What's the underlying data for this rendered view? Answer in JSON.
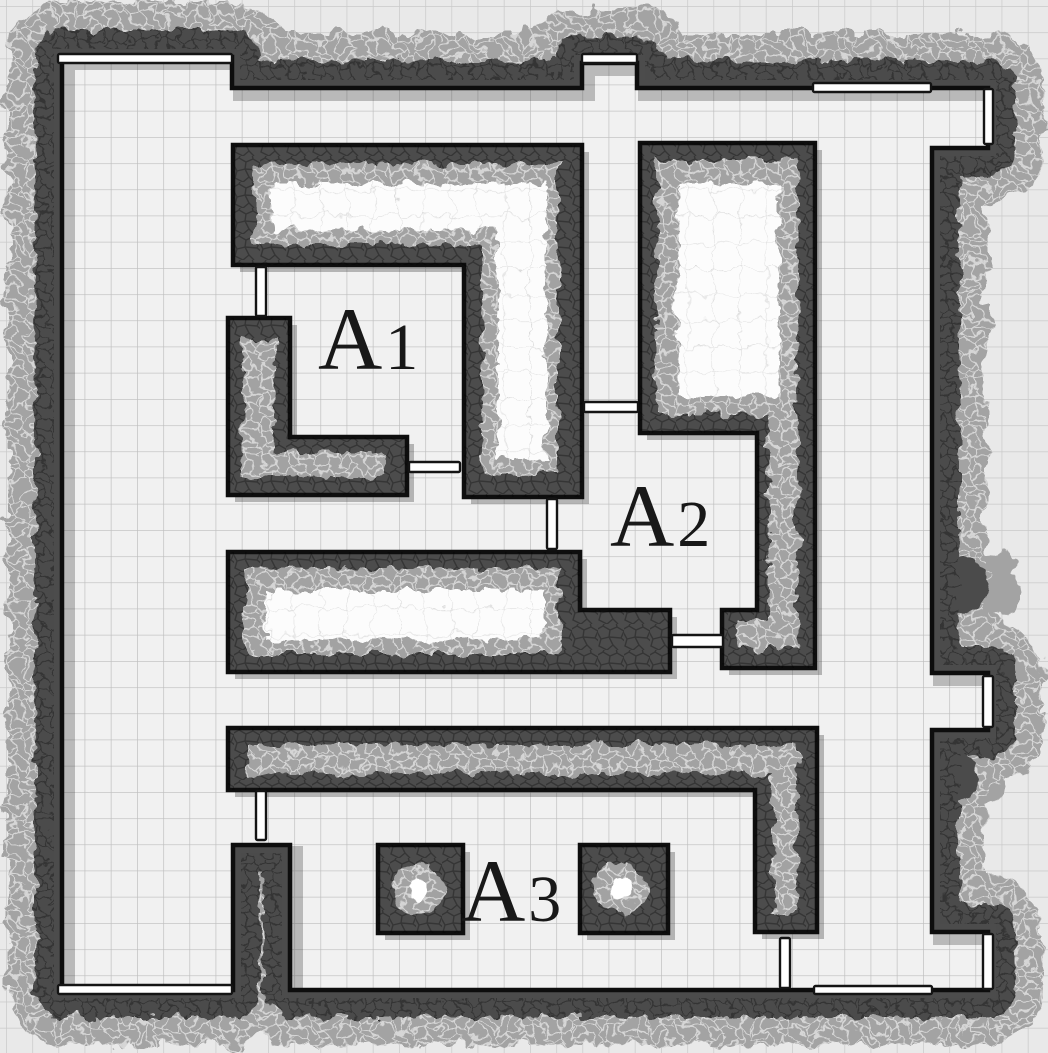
{
  "map": {
    "type": "dungeon-floorplan",
    "grid_size_px": 26.2,
    "rooms": [
      {
        "id": "A1",
        "label": "A1",
        "letter": "A",
        "digit": "1"
      },
      {
        "id": "A2",
        "label": "A2",
        "letter": "A",
        "digit": "2"
      },
      {
        "id": "A3",
        "label": "A3",
        "letter": "A",
        "digit": "3"
      }
    ],
    "doors": [
      {
        "id": "door-left-room-north",
        "x": 58,
        "y": 54,
        "w": 174,
        "h": 9,
        "orientation": "horizontal"
      },
      {
        "id": "door-north-corridor-top",
        "x": 582,
        "y": 54,
        "w": 55,
        "h": 9,
        "orientation": "horizontal"
      },
      {
        "id": "door-ne-corridor-north",
        "x": 813,
        "y": 83,
        "w": 118,
        "h": 9,
        "orientation": "horizontal"
      },
      {
        "id": "door-ne-corridor-east",
        "x": 984,
        "y": 89,
        "w": 9,
        "h": 55,
        "orientation": "vertical"
      },
      {
        "id": "door-a1-west",
        "x": 256,
        "y": 267,
        "w": 10,
        "h": 49,
        "orientation": "vertical"
      },
      {
        "id": "door-a1-south",
        "x": 409,
        "y": 462,
        "w": 51,
        "h": 10,
        "orientation": "horizontal"
      },
      {
        "id": "door-corridor-to-a2",
        "x": 584,
        "y": 402,
        "w": 54,
        "h": 10,
        "orientation": "horizontal"
      },
      {
        "id": "door-a1-a2-passage",
        "x": 547,
        "y": 499,
        "w": 10,
        "h": 50,
        "orientation": "vertical"
      },
      {
        "id": "door-a2-southeast",
        "x": 672,
        "y": 635,
        "w": 51,
        "h": 12,
        "orientation": "horizontal"
      },
      {
        "id": "door-east-corridor-east",
        "x": 983,
        "y": 676,
        "w": 10,
        "h": 51,
        "orientation": "vertical"
      },
      {
        "id": "door-west-passage-a3",
        "x": 256,
        "y": 791,
        "w": 10,
        "h": 49,
        "orientation": "vertical"
      },
      {
        "id": "door-south-corridor",
        "x": 780,
        "y": 938,
        "w": 10,
        "h": 50,
        "orientation": "vertical"
      },
      {
        "id": "door-se-corner-east",
        "x": 983,
        "y": 934,
        "w": 10,
        "h": 55,
        "orientation": "vertical"
      },
      {
        "id": "door-south-wall-secret",
        "x": 814,
        "y": 986,
        "w": 118,
        "h": 8,
        "orientation": "horizontal"
      },
      {
        "id": "door-left-room-south",
        "x": 58,
        "y": 985,
        "w": 174,
        "h": 9,
        "orientation": "horizontal"
      }
    ],
    "pillars": [
      {
        "id": "pillar-a3-west",
        "x": 378,
        "y": 845,
        "w": 85,
        "h": 88
      },
      {
        "id": "pillar-a3-east",
        "x": 580,
        "y": 845,
        "w": 88,
        "h": 88
      }
    ],
    "colors": {
      "background": "#e9e9e9",
      "floor": "#f1f1f1",
      "grid_line": "#bdbdbd",
      "wall_dark": "#4c4c4c",
      "wall_light_fringe": "#a3a3a3",
      "wall_outline": "#0d0d0d",
      "hollow_white": "#fcfcfc",
      "door_fill": "#ffffff",
      "label_color": "#181818"
    }
  }
}
